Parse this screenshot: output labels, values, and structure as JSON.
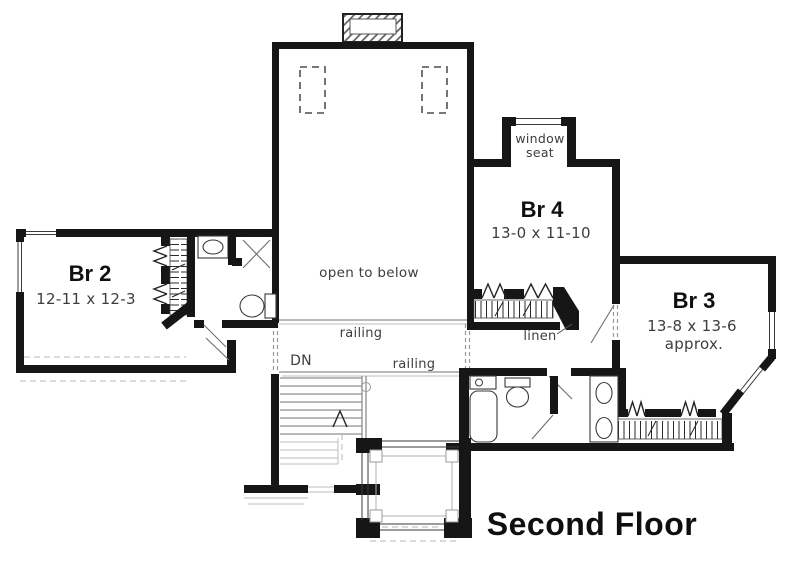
{
  "title": "Second Floor",
  "rooms": {
    "br2": {
      "name": "Br 2",
      "dims": "12-11 x 12-3"
    },
    "br4": {
      "name": "Br 4",
      "dims": "13-0 x 11-10"
    },
    "br3": {
      "name": "Br 3",
      "dims": "13-8 x 13-6",
      "note": "approx."
    }
  },
  "labels": {
    "open_to_below": "open to below",
    "railing_upper": "railing",
    "railing_lower": "railing",
    "down": "DN",
    "linen": "linen",
    "window_seat_1": "window",
    "window_seat_2": "seat"
  },
  "colors": {
    "walls": "#161616",
    "thin_lines": "#3a3a3a",
    "gray_lines": "#9a9a9a",
    "background": "#ffffff"
  }
}
